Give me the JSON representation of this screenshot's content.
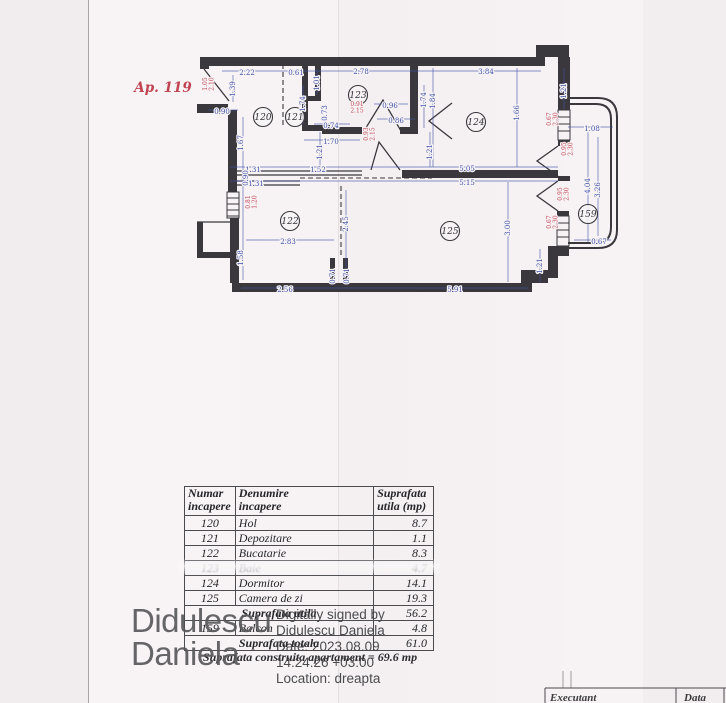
{
  "plan": {
    "apartment_label": "Ap. 119",
    "colors": {
      "wall": "#3a383d",
      "dim_blue": "#3f51a8",
      "dim_red": "#c24555"
    },
    "rooms": [
      {
        "number": "120",
        "x": 263,
        "y": 117
      },
      {
        "number": "121",
        "x": 295,
        "y": 117
      },
      {
        "number": "123",
        "x": 358,
        "y": 95
      },
      {
        "number": "124",
        "x": 476,
        "y": 122
      },
      {
        "number": "122",
        "x": 290,
        "y": 221
      },
      {
        "number": "125",
        "x": 450,
        "y": 231
      },
      {
        "number": "159",
        "x": 588,
        "y": 214
      }
    ],
    "dims_blue": [
      {
        "t": "2.22",
        "x": 247,
        "y": 73,
        "v": false
      },
      {
        "t": "0.61",
        "x": 296,
        "y": 73,
        "v": false
      },
      {
        "t": "2.78",
        "x": 361,
        "y": 72,
        "v": false
      },
      {
        "t": "3.84",
        "x": 486,
        "y": 72,
        "v": false
      },
      {
        "t": "0.90",
        "x": 222,
        "y": 112,
        "v": false
      },
      {
        "t": "0.74",
        "x": 331,
        "y": 126,
        "v": false
      },
      {
        "t": "0.96",
        "x": 390,
        "y": 106,
        "v": false
      },
      {
        "t": "0.86",
        "x": 396,
        "y": 121,
        "v": false
      },
      {
        "t": "1.70",
        "x": 331,
        "y": 142,
        "v": false
      },
      {
        "t": "1.31",
        "x": 253,
        "y": 170,
        "v": false
      },
      {
        "t": "1.52",
        "x": 318,
        "y": 170,
        "v": false
      },
      {
        "t": "5.05",
        "x": 467,
        "y": 169,
        "v": false
      },
      {
        "t": "1.31",
        "x": 256,
        "y": 184,
        "v": false
      },
      {
        "t": "5.15",
        "x": 467,
        "y": 183,
        "v": false
      },
      {
        "t": "2.83",
        "x": 288,
        "y": 242,
        "v": false
      },
      {
        "t": "2.56",
        "x": 285,
        "y": 290,
        "v": false
      },
      {
        "t": "5.91",
        "x": 455,
        "y": 290,
        "v": false
      },
      {
        "t": "1.08",
        "x": 592,
        "y": 129,
        "v": false
      },
      {
        "t": "0.67",
        "x": 599,
        "y": 242,
        "v": false
      },
      {
        "t": "1.39",
        "x": 233,
        "y": 89,
        "v": true
      },
      {
        "t": "1.01",
        "x": 317,
        "y": 83,
        "v": true
      },
      {
        "t": "1.74",
        "x": 303,
        "y": 104,
        "v": true
      },
      {
        "t": "0.73",
        "x": 325,
        "y": 113,
        "v": true
      },
      {
        "t": "1.21",
        "x": 320,
        "y": 152,
        "v": true
      },
      {
        "t": "1.74",
        "x": 424,
        "y": 100,
        "v": true
      },
      {
        "t": "1.84",
        "x": 433,
        "y": 101,
        "v": true
      },
      {
        "t": "1.21",
        "x": 430,
        "y": 152,
        "v": true
      },
      {
        "t": "1.66",
        "x": 517,
        "y": 113,
        "v": true
      },
      {
        "t": "1.21",
        "x": 564,
        "y": 91,
        "v": true
      },
      {
        "t": "1.67",
        "x": 241,
        "y": 143,
        "v": true
      },
      {
        "t": "0.90",
        "x": 246,
        "y": 178,
        "v": true
      },
      {
        "t": "2.45",
        "x": 346,
        "y": 224,
        "v": true
      },
      {
        "t": "1.58",
        "x": 241,
        "y": 258,
        "v": true
      },
      {
        "t": "0.71",
        "x": 333,
        "y": 276,
        "v": true
      },
      {
        "t": "0.71",
        "x": 347,
        "y": 276,
        "v": true
      },
      {
        "t": "3.00",
        "x": 508,
        "y": 228,
        "v": true
      },
      {
        "t": "1.21",
        "x": 540,
        "y": 266,
        "v": true
      },
      {
        "t": "4.04",
        "x": 588,
        "y": 186,
        "v": true
      },
      {
        "t": "3.26",
        "x": 598,
        "y": 190,
        "v": true
      }
    ],
    "dims_red": [
      {
        "a": "1.05",
        "b": "2.10",
        "x": 207,
        "y": 84,
        "v": true
      },
      {
        "a": "0.81",
        "b": "1.20",
        "x": 250,
        "y": 202,
        "v": true
      },
      {
        "a": "0.91",
        "b": "2.15",
        "x": 357,
        "y": 106,
        "v": false
      },
      {
        "a": "0.93",
        "b": "2.15",
        "x": 368,
        "y": 134,
        "v": true
      },
      {
        "a": "0.67",
        "b": "2.30",
        "x": 551,
        "y": 119,
        "v": true
      },
      {
        "a": "0.95",
        "b": "2.30",
        "x": 566,
        "y": 149,
        "v": true
      },
      {
        "a": "0.95",
        "b": "2.30",
        "x": 562,
        "y": 194,
        "v": true
      },
      {
        "a": "0.67",
        "b": "2.30",
        "x": 551,
        "y": 222,
        "v": true
      }
    ]
  },
  "table": {
    "headers": {
      "col1": "Numar\nincapere",
      "col2": "Denumire\nincapere",
      "col3": "Suprafata\nutila (mp)"
    },
    "rows": [
      {
        "num": "120",
        "name": "Hol",
        "val": "8.7"
      },
      {
        "num": "121",
        "name": "Depozitare",
        "val": "1.1"
      },
      {
        "num": "122",
        "name": "Bucatarie",
        "val": "8.3"
      },
      {
        "num": "123",
        "name": "Baie",
        "val": "4.7"
      },
      {
        "num": "124",
        "name": "Dormitor",
        "val": "14.1"
      },
      {
        "num": "125",
        "name": "Camera de zi",
        "val": "19.3"
      }
    ],
    "subtotal": {
      "label": "Suprafata utila",
      "val": "56.2"
    },
    "balcony_row": {
      "num": "159",
      "name": "Balcon",
      "val": "4.8"
    },
    "total": {
      "label": "Suprafata totala",
      "val": "61.0"
    },
    "footnote": "Suprafata construita apartament = 69.6 mp"
  },
  "signature": {
    "big_line1": "Didulescu",
    "big_line2": "Daniela",
    "details": [
      "Digitally signed by",
      "Didulescu Daniela",
      "Date: 2023.08.09",
      "14:24:26 +03:00",
      "Location: dreapta"
    ]
  },
  "footer": {
    "executant_label": "Executant",
    "data_label": "Data"
  }
}
